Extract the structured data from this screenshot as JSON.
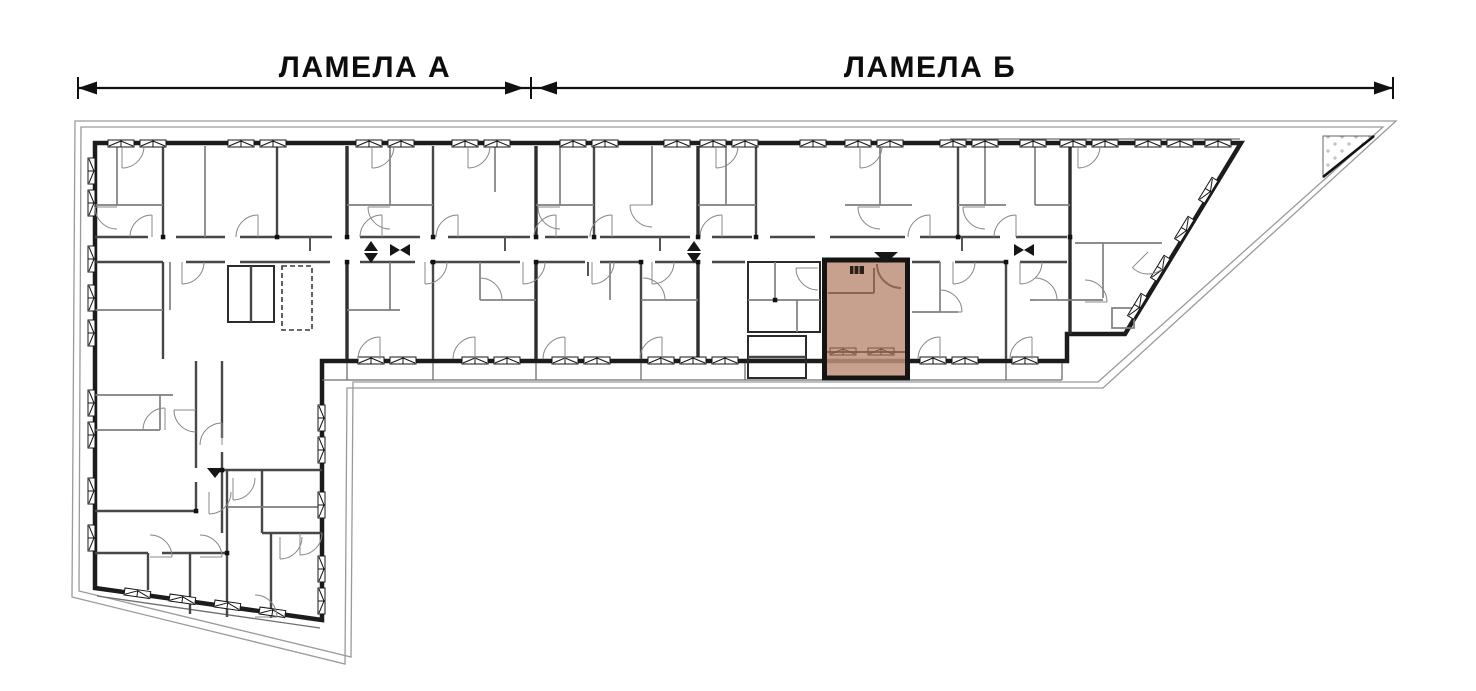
{
  "header": {
    "section_a_label": "ЛАМЕЛА А",
    "section_b_label": "ЛАМЕЛА Б"
  },
  "plan": {
    "highlighted_unit": {
      "fill": "#bd8f7a",
      "border_color": "#141414",
      "location": "lamela-b-center"
    },
    "colors": {
      "outer_wall": "#1c1c1c",
      "interior_wall": "#474747",
      "minor_wall": "#7e7e7e",
      "site_boundary": "#9a9a9a",
      "dimension_line": "#111111",
      "background": "#ffffff"
    },
    "icons": {
      "window": "casement-glyph-box-with-flaps",
      "door": "quarter-circle-swing-arc",
      "stairs": "hatched-rectangle",
      "elevator": "dashed-rectangle",
      "entrance_marker": "filled-triangle",
      "dimension_arrow": "filled-arrowhead",
      "terrace": "dotted-triangle"
    }
  }
}
